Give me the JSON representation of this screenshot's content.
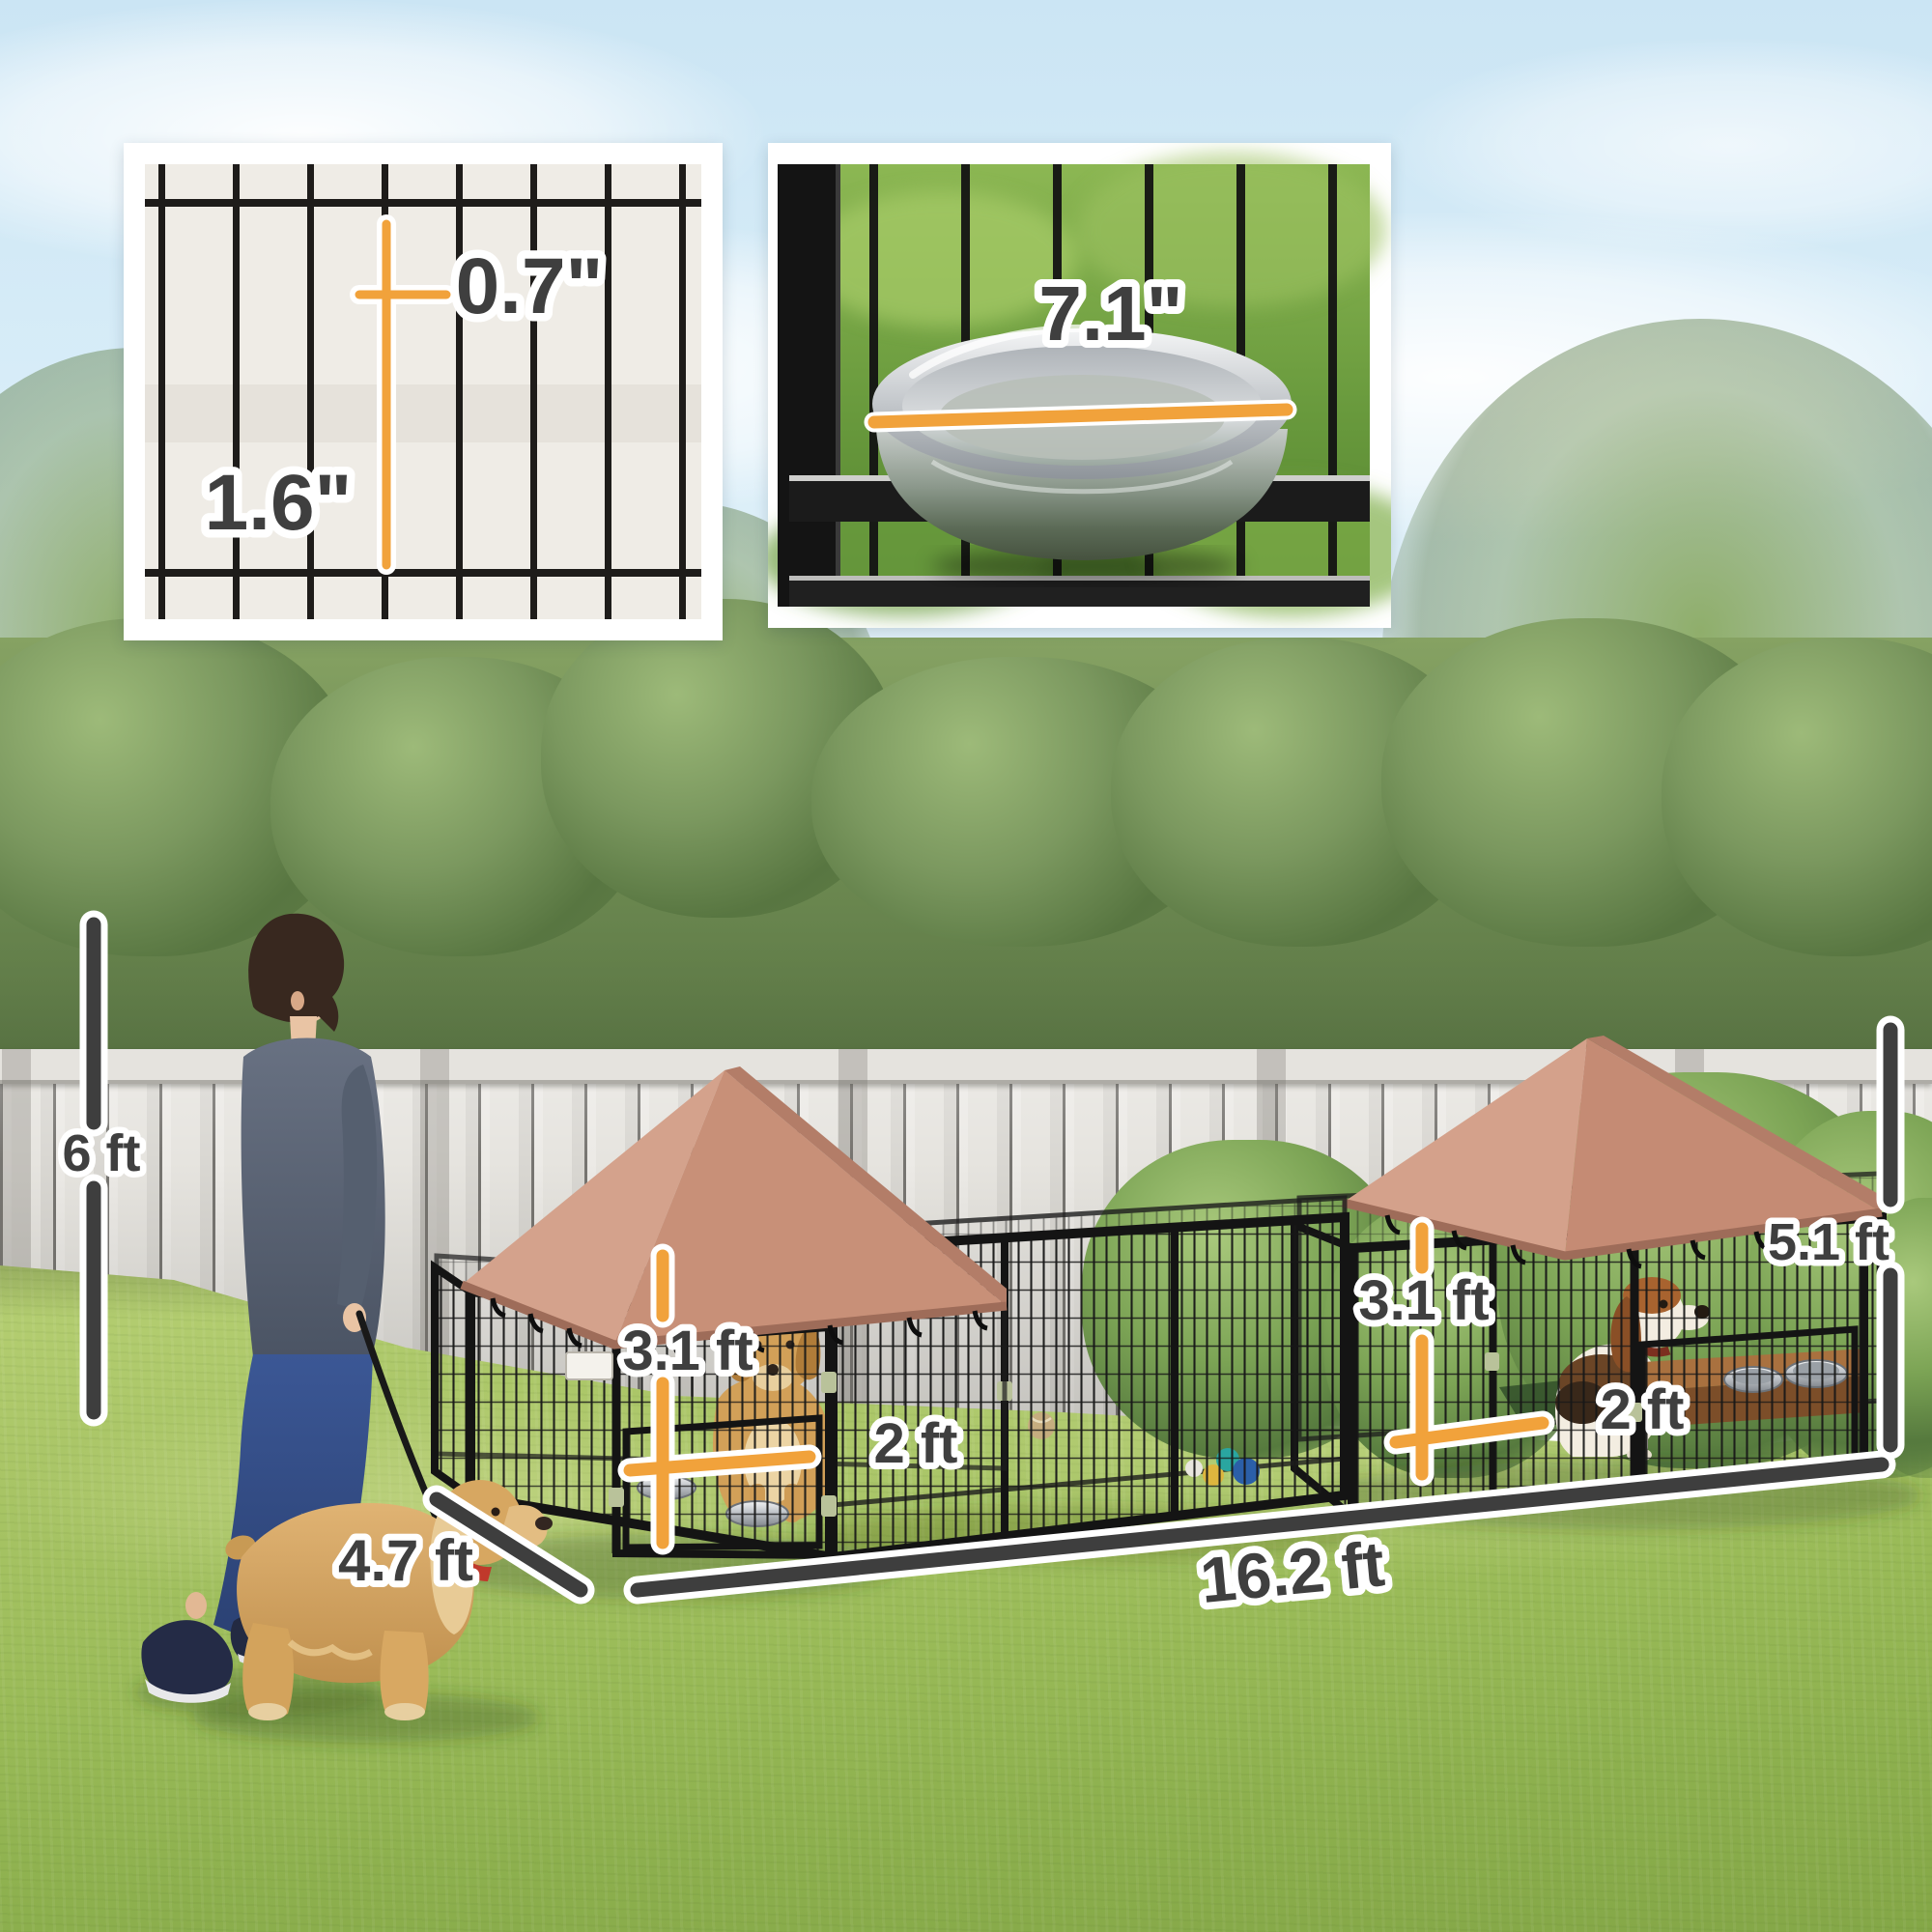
{
  "insets": {
    "mesh_card": {
      "label_wire_horizontal_gap": "0.7\"",
      "label_wire_vertical_gap": "1.6\""
    },
    "bowl_card": {
      "label_bowl_diameter": "7.1\""
    }
  },
  "dimensions": {
    "yard_fence_height": "6 ft",
    "left_kennel_panel_height": "3.1 ft",
    "left_kennel_door_width": "2 ft",
    "right_kennel_panel_height": "3.1 ft",
    "right_kennel_door_width": "2 ft",
    "kennel_total_height": "5.1 ft",
    "kennel_depth": "4.7 ft",
    "kennel_total_length": "16.2 ft"
  },
  "colors": {
    "accent_orange": "#f1a23b",
    "dimension_dark_gray": "#3e3e3e",
    "canopy_rose": "#c98f7b",
    "kennel_metal_black": "#161616",
    "grass_green": "#a4c063",
    "hedge_green": "#6d8a51",
    "fence_gray": "#e6e4df",
    "sky_blue": "#d8edf8"
  }
}
